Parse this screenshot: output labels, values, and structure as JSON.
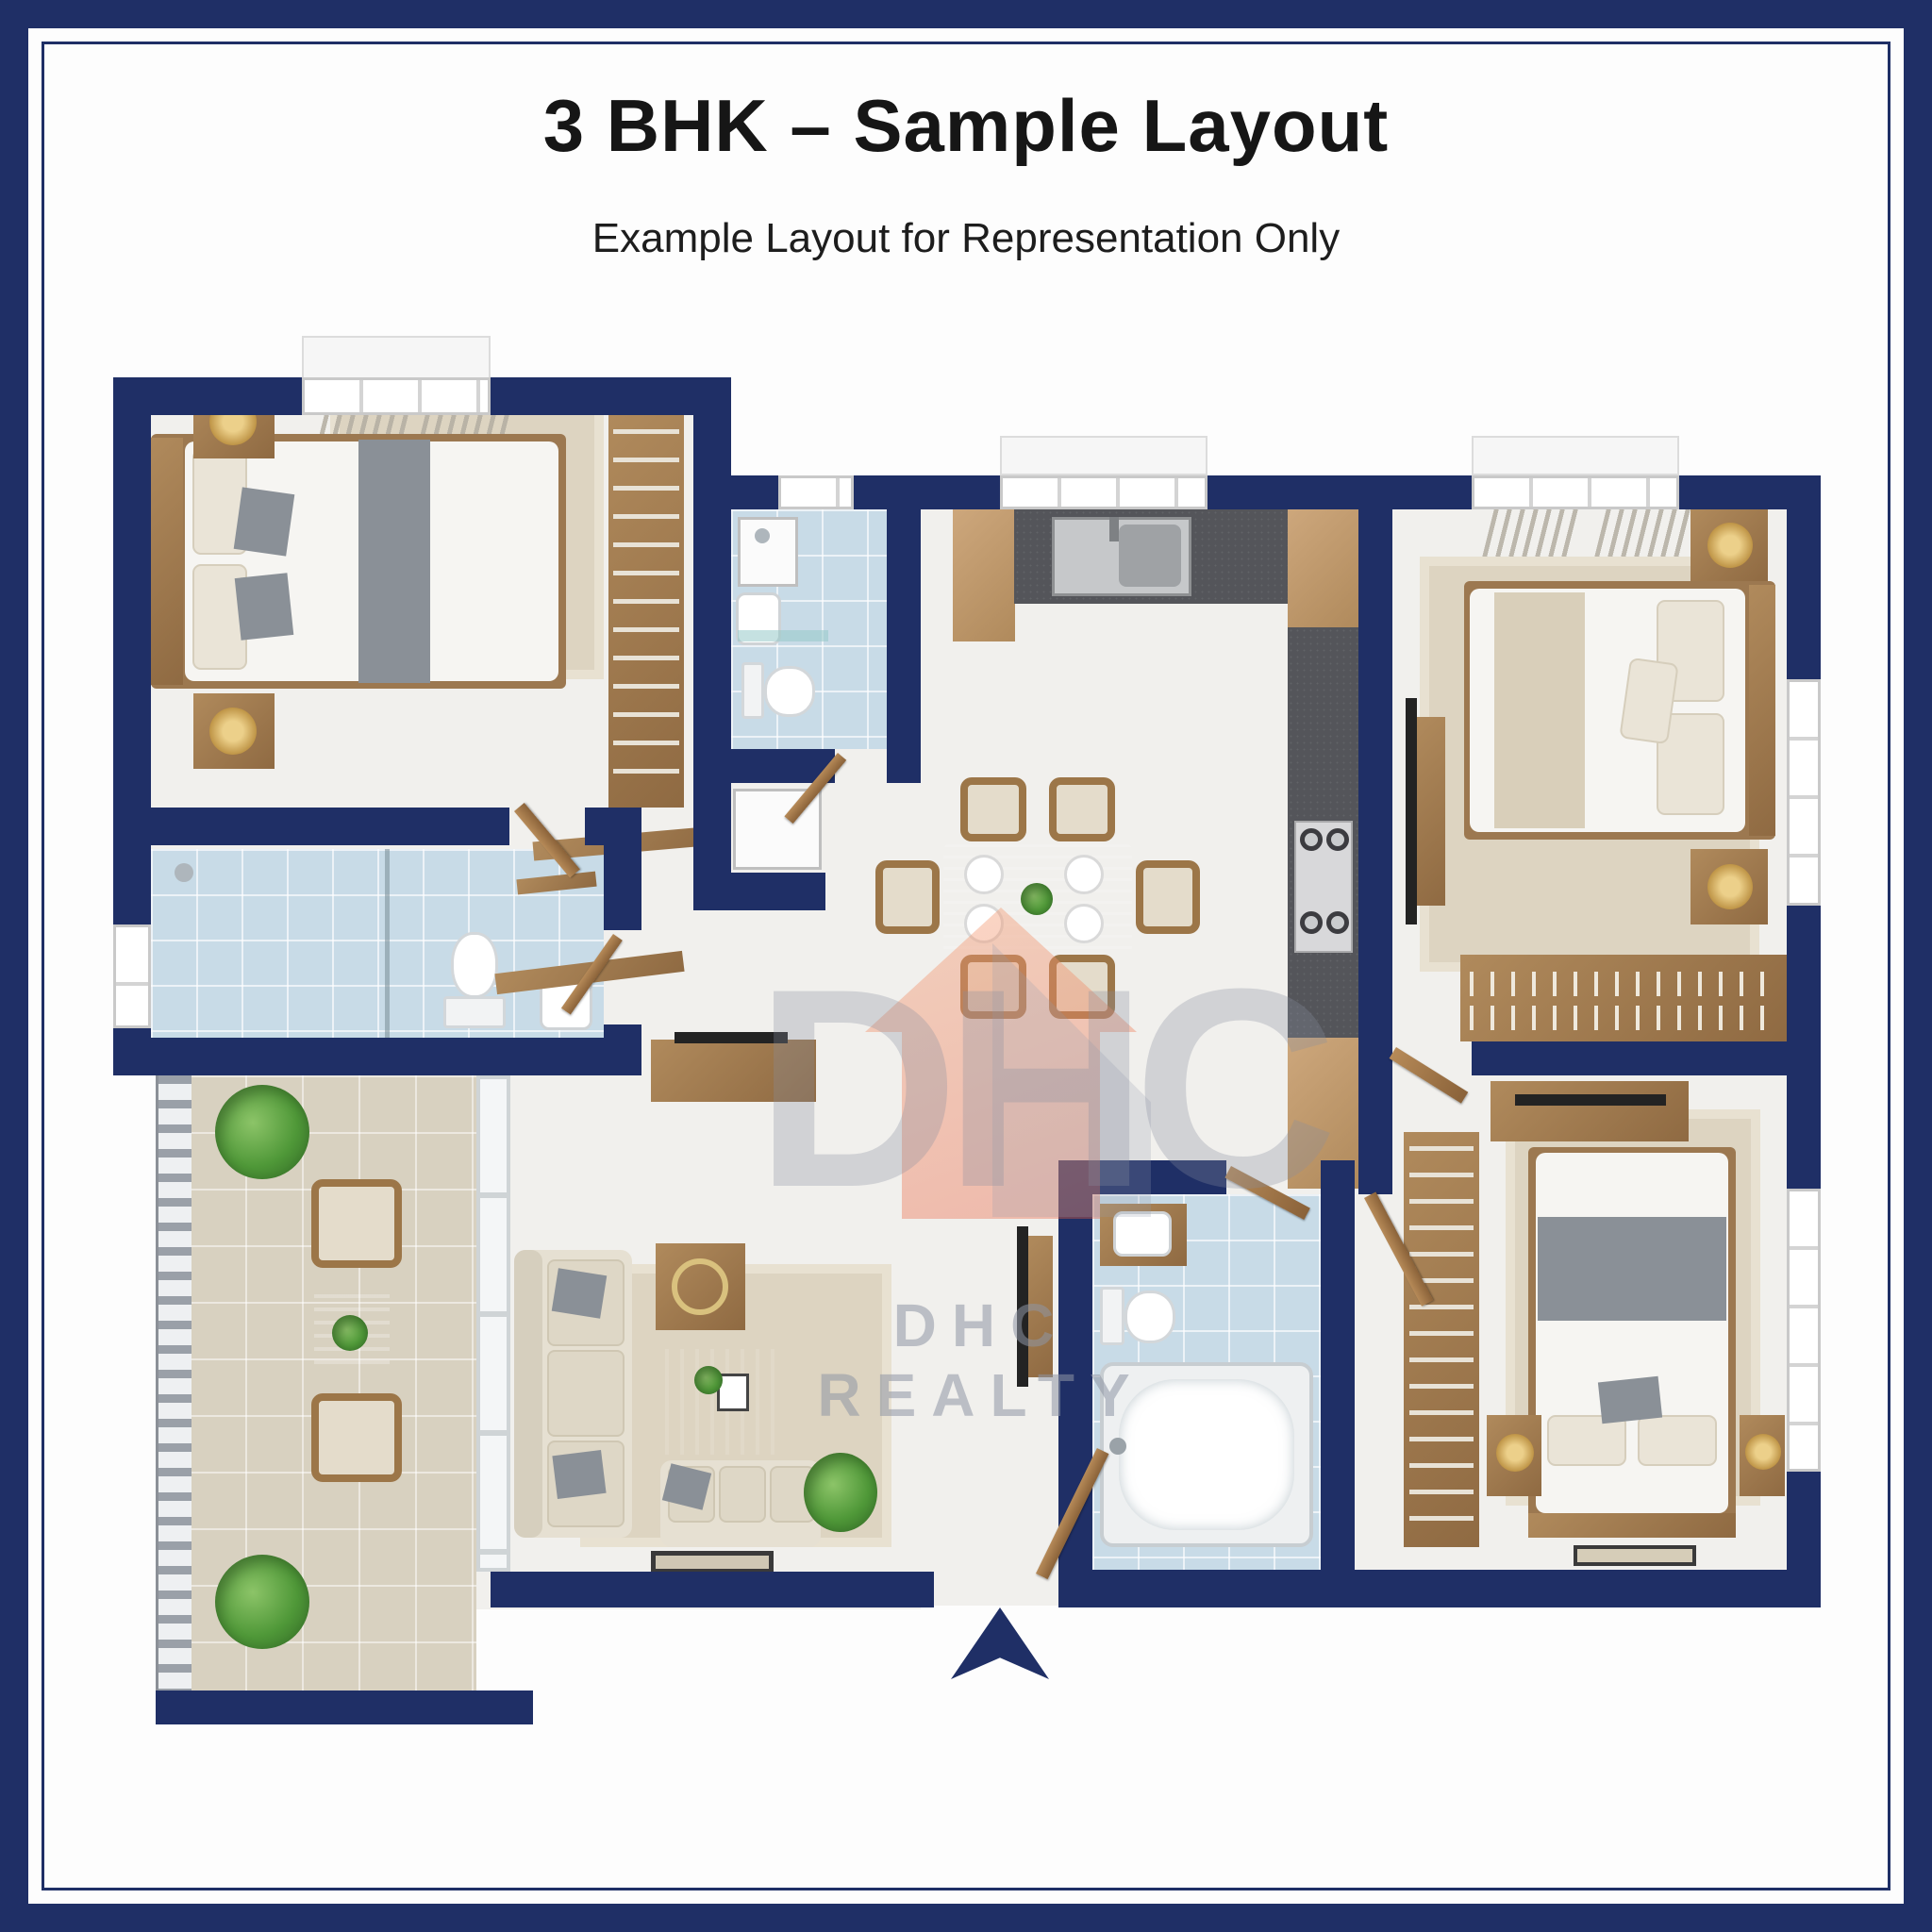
{
  "header": {
    "title": "3 BHK – Sample Layout",
    "subtitle": "Example Layout for Representation Only"
  },
  "watermark": {
    "monogram": "DHC",
    "brand": "DHC REALTY"
  },
  "icons": {
    "entry_arrow": "entry-direction-arrow"
  },
  "colors": {
    "wall_navy": "#1f2f66",
    "floor": "#f1f0ed",
    "bath_tile": "#c8dbe7",
    "balcony_tile": "#d8d1c0",
    "counter_dark": "#54555a",
    "wood": "#a0784e",
    "wood_light": "#c29b6e",
    "fabric": "#e6e0d4",
    "blanket_gray": "#8a9097",
    "rug": "#ddd4c1",
    "plant_green": "#539a3c",
    "steel": "#c6c8ca",
    "logo_orange": "#ef9a6f",
    "watermark_gray": "#8d93a6",
    "title_color": "#161616"
  }
}
